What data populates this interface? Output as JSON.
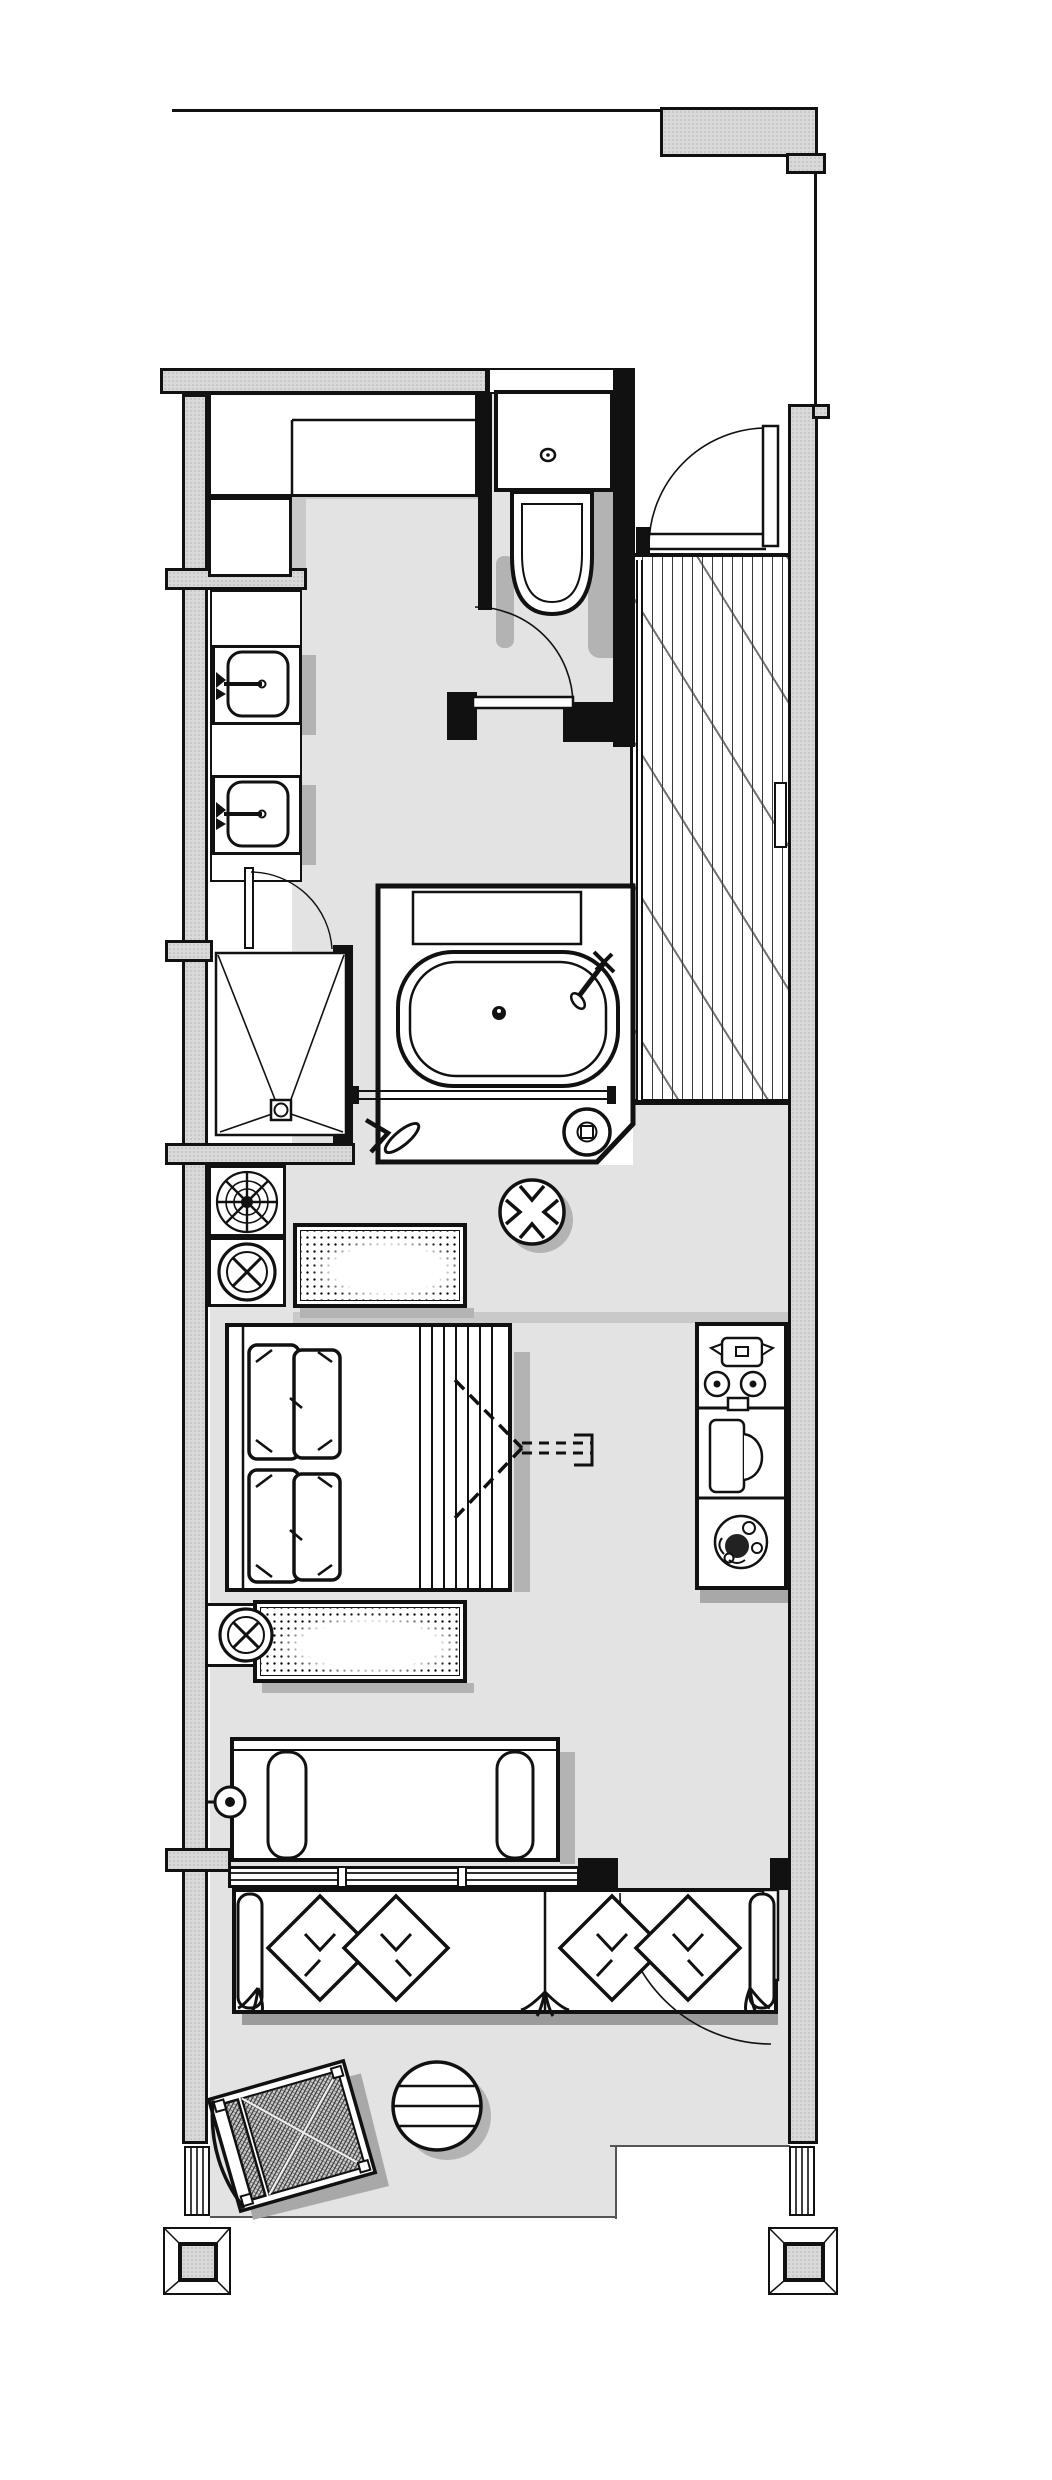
{
  "document": {
    "type": "architectural floor plan",
    "title": "Hotel guest room floor plan",
    "orientation": "portrait",
    "visible_text": "none"
  },
  "palette": {
    "paper": "#ffffff",
    "floor": "#e3e3e3",
    "wall": "#d9d9d9",
    "line": "#111111",
    "shadow": "#b3b3b3",
    "shadow_dark": "#9b9b9b",
    "shadow_soft": "#c9c9c9"
  },
  "rooms": [
    {
      "id": "corridor",
      "label": "corridor (top, outside unit)"
    },
    {
      "id": "entry-hall",
      "label": "entry hall with wood plank flooring"
    },
    {
      "id": "wc",
      "label": "toilet room with swing door"
    },
    {
      "id": "closet",
      "label": "walk-in closet with counter"
    },
    {
      "id": "vanity",
      "label": "double washbasin vanity"
    },
    {
      "id": "shower",
      "label": "walk-in shower with corner-to-drain fall lines"
    },
    {
      "id": "bath",
      "label": "bathtub platform with head shelf and deck"
    },
    {
      "id": "bedroom",
      "label": "bedroom"
    },
    {
      "id": "balcony",
      "label": "balcony / terrace"
    }
  ],
  "fixtures": [
    "toilet with cistern and flush knob",
    "washbasin upper",
    "washbasin lower",
    "oval bathtub with centre drain and deck-mounted mixer",
    "towel rail",
    "floor drain",
    "shower drain",
    "glass door pivot handle",
    "entry swing door",
    "wc swing door",
    "shower swing door",
    "balcony swing door",
    "fan-coil unit (spiral symbol)",
    "shut-off valve circle-x upper",
    "shut-off valve circle-x lower",
    "stipple-textured bench above bed",
    "stipple-textured bench below bed",
    "double bed with four pillows and striped foot runner",
    "tv swivel sight-line (dashed)",
    "round pouf with four arrows",
    "coffee / tea station",
    "writing desk with chair",
    "potted plant",
    "settee with two armrests",
    "wall reading light",
    "triple-panel window",
    "outdoor sofa with four diamond cushions",
    "round slatted side table",
    "rotated rattan lounge chair",
    "framed pilaster column left",
    "framed pilaster column right",
    "beveled column base left",
    "beveled column base right"
  ],
  "annotations": {
    "dimensions_shown": false,
    "scale_shown": false
  }
}
